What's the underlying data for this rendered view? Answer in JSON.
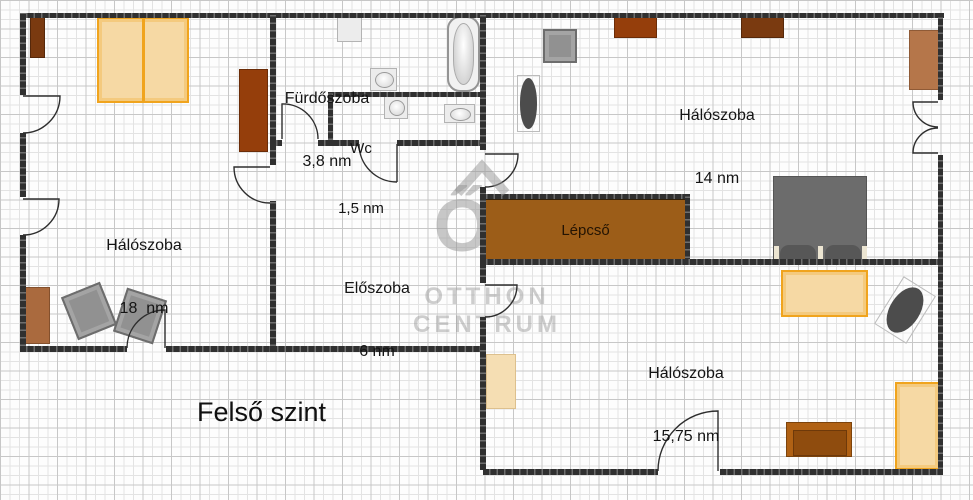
{
  "plan": {
    "floor_label": "Felső szint",
    "rooms": {
      "haloszoba_18": {
        "name": "Hálószoba",
        "area": "18  nm"
      },
      "furdoszoba": {
        "name": "Fürdőszoba",
        "area": "3,8 nm"
      },
      "wc": {
        "name": "Wc",
        "area": "1,5 nm"
      },
      "haloszoba_14": {
        "name": "Hálószoba",
        "area": "14 nm"
      },
      "eloszoba": {
        "name": "Előszoba",
        "area": "6 nm"
      },
      "lepcso": {
        "name": "Lépcső"
      },
      "haloszoba_1575": {
        "name": "Hálószoba",
        "area": "15,75 nm"
      }
    },
    "watermark": {
      "monogram": "ŐC",
      "line1": "OTTHON",
      "line2": "CENTRUM"
    },
    "colors": {
      "wall": "#303030",
      "grid_minor": "#e3e3e3",
      "grid_major": "#c7c7c7",
      "stairs_fill": "#9c5d18",
      "bed_frame_orange": "#f0a41e",
      "bed_fill_tan": "#f6d9a4",
      "furniture_dark_brown": "#7a3a10",
      "furniture_red_brown": "#953e0b",
      "furniture_sienna": "#aa6a3e",
      "furniture_gray": "#919191",
      "bed_gray": "#6c6c6c",
      "watermark_gray": "#9a9a9a"
    }
  }
}
